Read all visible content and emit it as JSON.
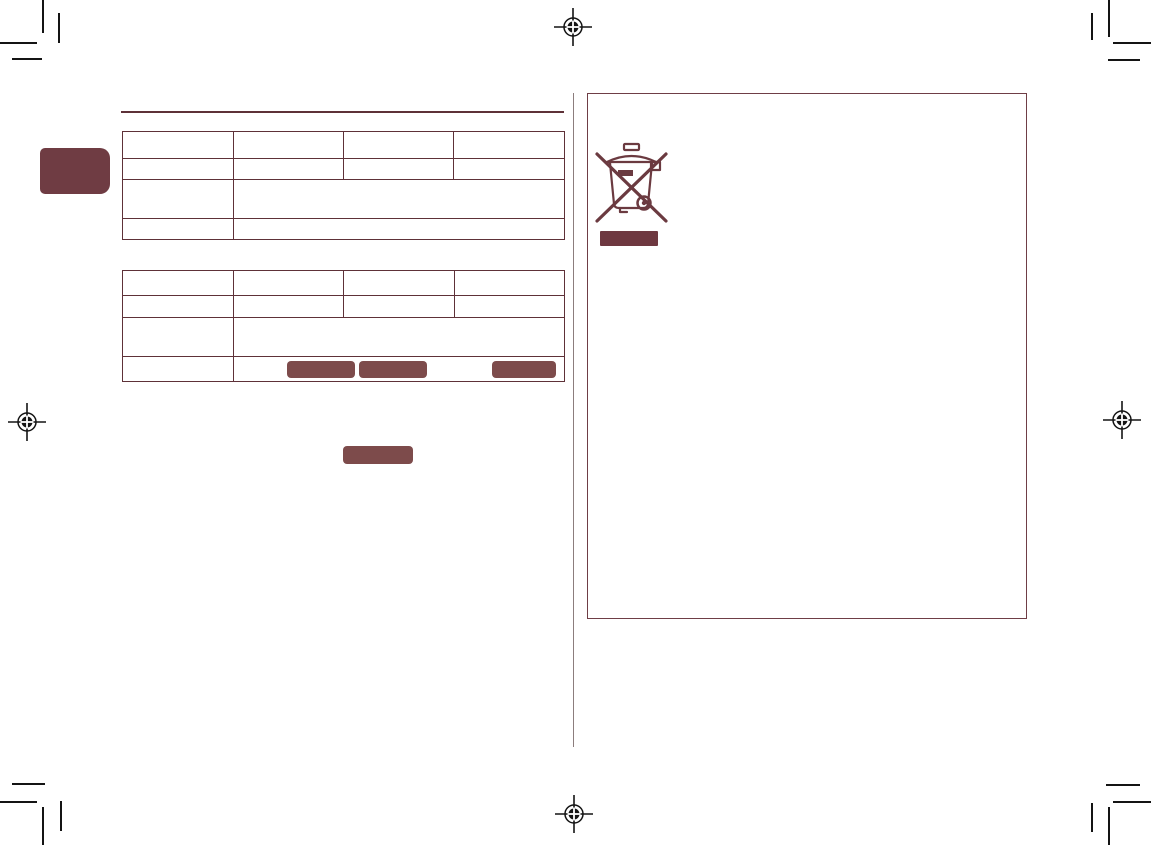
{
  "page": {
    "kind": "scanned-print-document-page",
    "background": "#ffffff",
    "width": 1151,
    "height": 845
  },
  "colors": {
    "accent_maroon": "#6f3c43",
    "table_border": "#5e3138",
    "box_border": "#6f3e46",
    "redaction_fill": "#7d4b4b",
    "weee_bar_fill": "#6e3840",
    "crop_mark_black": "#141414",
    "center_divider": "#8c7d7d"
  },
  "left_tab": {
    "label": ""
  },
  "section_rule": {
    "present": true
  },
  "tables": {
    "table1": {
      "columns": 4,
      "rows": 4,
      "cells": [
        [
          "",
          "",
          "",
          ""
        ],
        [
          "",
          "",
          "",
          ""
        ],
        [
          "",
          ""
        ],
        [
          "",
          ""
        ]
      ]
    },
    "table2": {
      "columns": 4,
      "rows": 4,
      "cells": [
        [
          "",
          "",
          "",
          ""
        ],
        [
          "",
          "",
          "",
          ""
        ],
        [
          "",
          ""
        ],
        [
          "",
          ""
        ]
      ],
      "row4_redacted_blocks": 3
    }
  },
  "redactions": {
    "standalone_block_count": 1,
    "weee_bar_count": 1
  },
  "icons": {
    "weee": "weee-crossed-out-wheelie-bin-icon",
    "registration": "registration-mark-icon"
  }
}
